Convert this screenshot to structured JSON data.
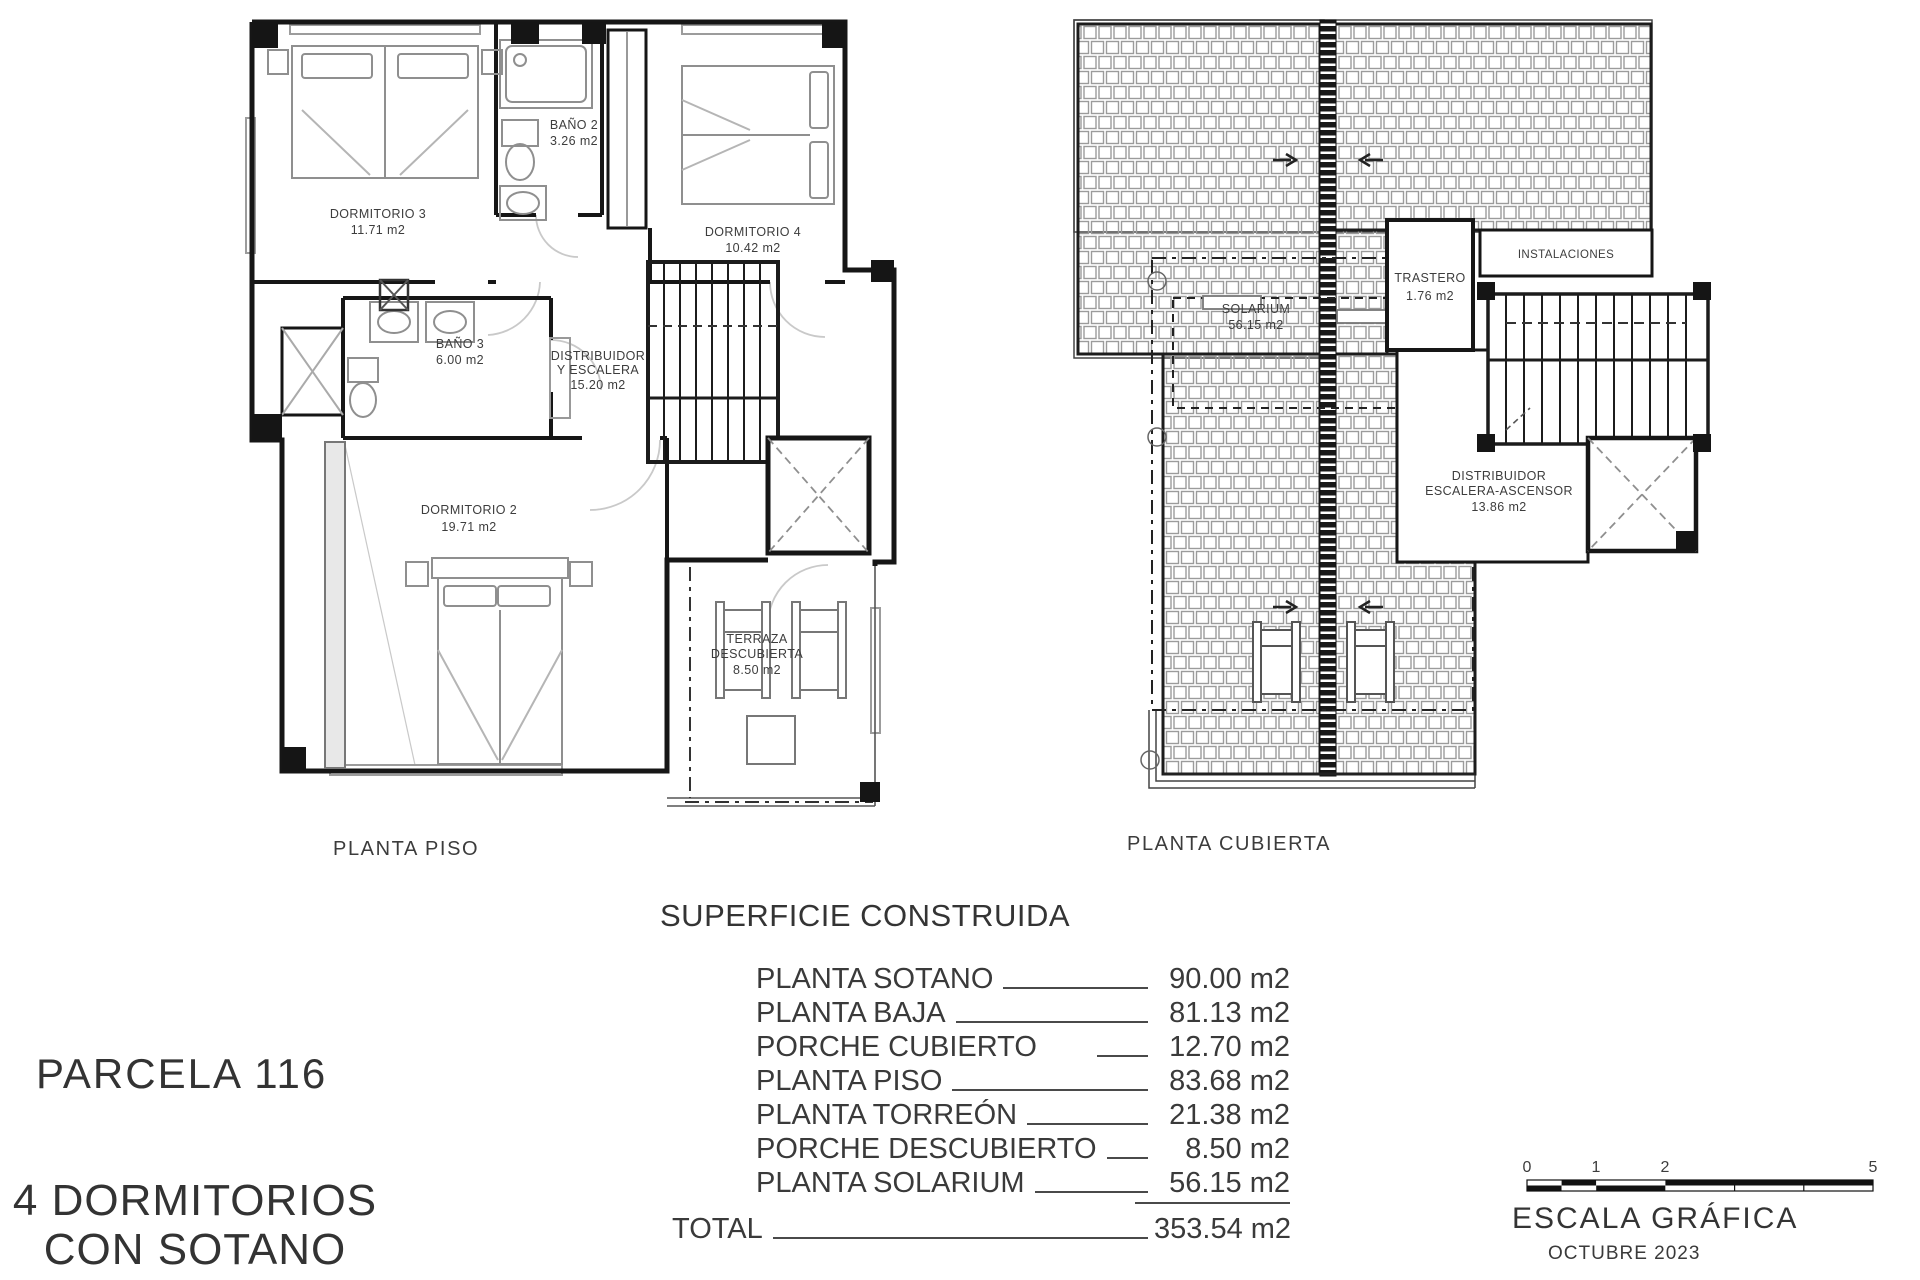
{
  "project": {
    "parcel": "PARCELA 116",
    "subtitle_line1": "4 DORMITORIOS",
    "subtitle_line2": "CON SOTANO"
  },
  "plans": {
    "piso": {
      "caption": "PLANTA PISO",
      "rooms": {
        "dormitorio3": {
          "name": "DORMITORIO 3",
          "area": "11.71 m2"
        },
        "bano2": {
          "name": "BAÑO 2",
          "area": "3.26 m2"
        },
        "dormitorio4": {
          "name": "DORMITORIO 4",
          "area": "10.42 m2"
        },
        "bano3": {
          "name": "BAÑO 3",
          "area": "6.00 m2"
        },
        "distribuidor": {
          "name_line1": "DISTRIBUIDOR",
          "name_line2": "Y ESCALERA",
          "area": "15.20 m2"
        },
        "dormitorio2": {
          "name": "DORMITORIO 2",
          "area": "19.71 m2"
        },
        "terraza": {
          "name_line1": "TERRAZA",
          "name_line2": "DESCUBIERTA",
          "area": "8.50 m2"
        }
      }
    },
    "cubierta": {
      "caption": "PLANTA CUBIERTA",
      "rooms": {
        "solarium": {
          "name": "SOLARIUM",
          "area": "56.15 m2"
        },
        "trastero": {
          "name": "TRASTERO",
          "area": "1.76 m2"
        },
        "instalaciones": {
          "name": "INSTALACIONES"
        },
        "distribuidor": {
          "name_line1": "DISTRIBUIDOR",
          "name_line2": "ESCALERA-ASCENSOR",
          "area": "13.86 m2"
        }
      }
    }
  },
  "surface_table": {
    "title": "SUPERFICIE CONSTRUIDA",
    "rows": [
      {
        "label": "PLANTA SOTANO",
        "value": "90.00 m2"
      },
      {
        "label": "PLANTA BAJA",
        "value": "81.13 m2"
      },
      {
        "label": "PORCHE CUBIERTO",
        "value": "12.70 m2"
      },
      {
        "label": "PLANTA PISO",
        "value": "83.68 m2"
      },
      {
        "label": "PLANTA TORREÓN",
        "value": "21.38 m2"
      },
      {
        "label": "PORCHE DESCUBIERTO",
        "value": "8.50 m2"
      },
      {
        "label": "PLANTA SOLARIUM",
        "value": "56.15 m2"
      }
    ],
    "total": {
      "label": "TOTAL",
      "value": "353.54 m2"
    }
  },
  "scale": {
    "title": "ESCALA GRÁFICA",
    "date": "OCTUBRE 2023",
    "ticks": [
      "0",
      "1",
      "2",
      "5"
    ]
  },
  "colors": {
    "ink": "#161616",
    "furniture": "#8f8f8f",
    "tile": "#9b9b9b",
    "light": "#c9c9c9"
  }
}
